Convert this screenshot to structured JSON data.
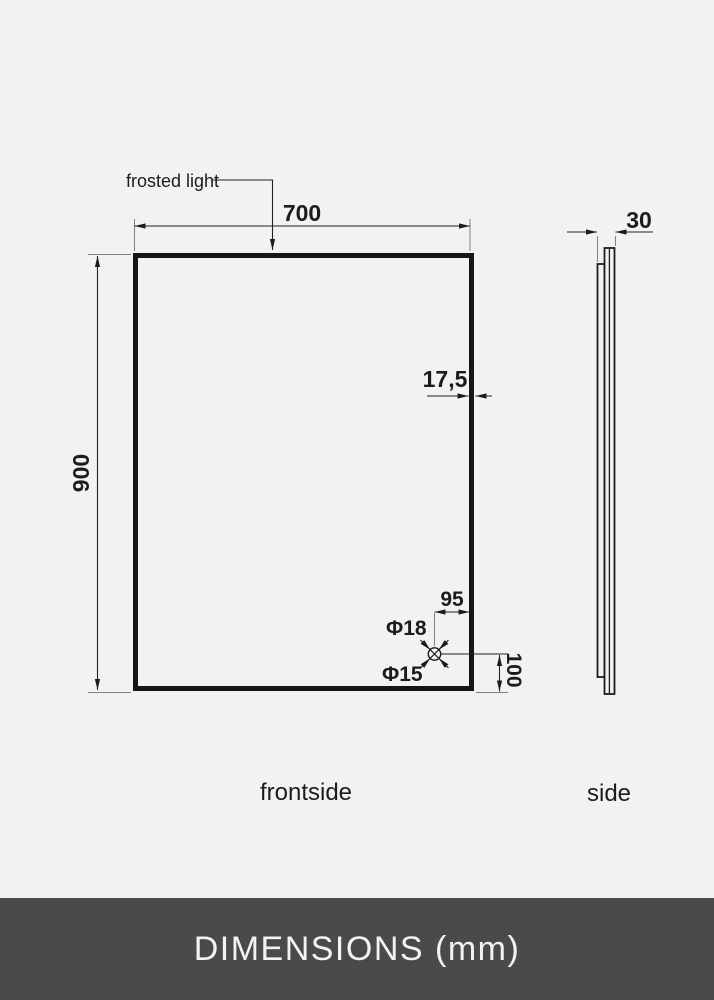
{
  "front_view": {
    "label": "frontside",
    "frosted_light_label": "frosted light",
    "dim_width": "700",
    "dim_height": "900",
    "dim_frame_depth": "17,5",
    "hole": {
      "dim_offset_right": "95",
      "dim_offset_bottom": "100",
      "outer_diameter": "Φ18",
      "inner_diameter": "Φ15"
    }
  },
  "side_view": {
    "label": "side",
    "dim_depth": "30"
  },
  "footer": {
    "label": "DIMENSIONS (mm)"
  },
  "colors": {
    "background": "#f2f2f2",
    "line_color": "#1c1c1c",
    "footer_background": "#4a4a4a",
    "footer_text_color": "#f2f2f2"
  }
}
